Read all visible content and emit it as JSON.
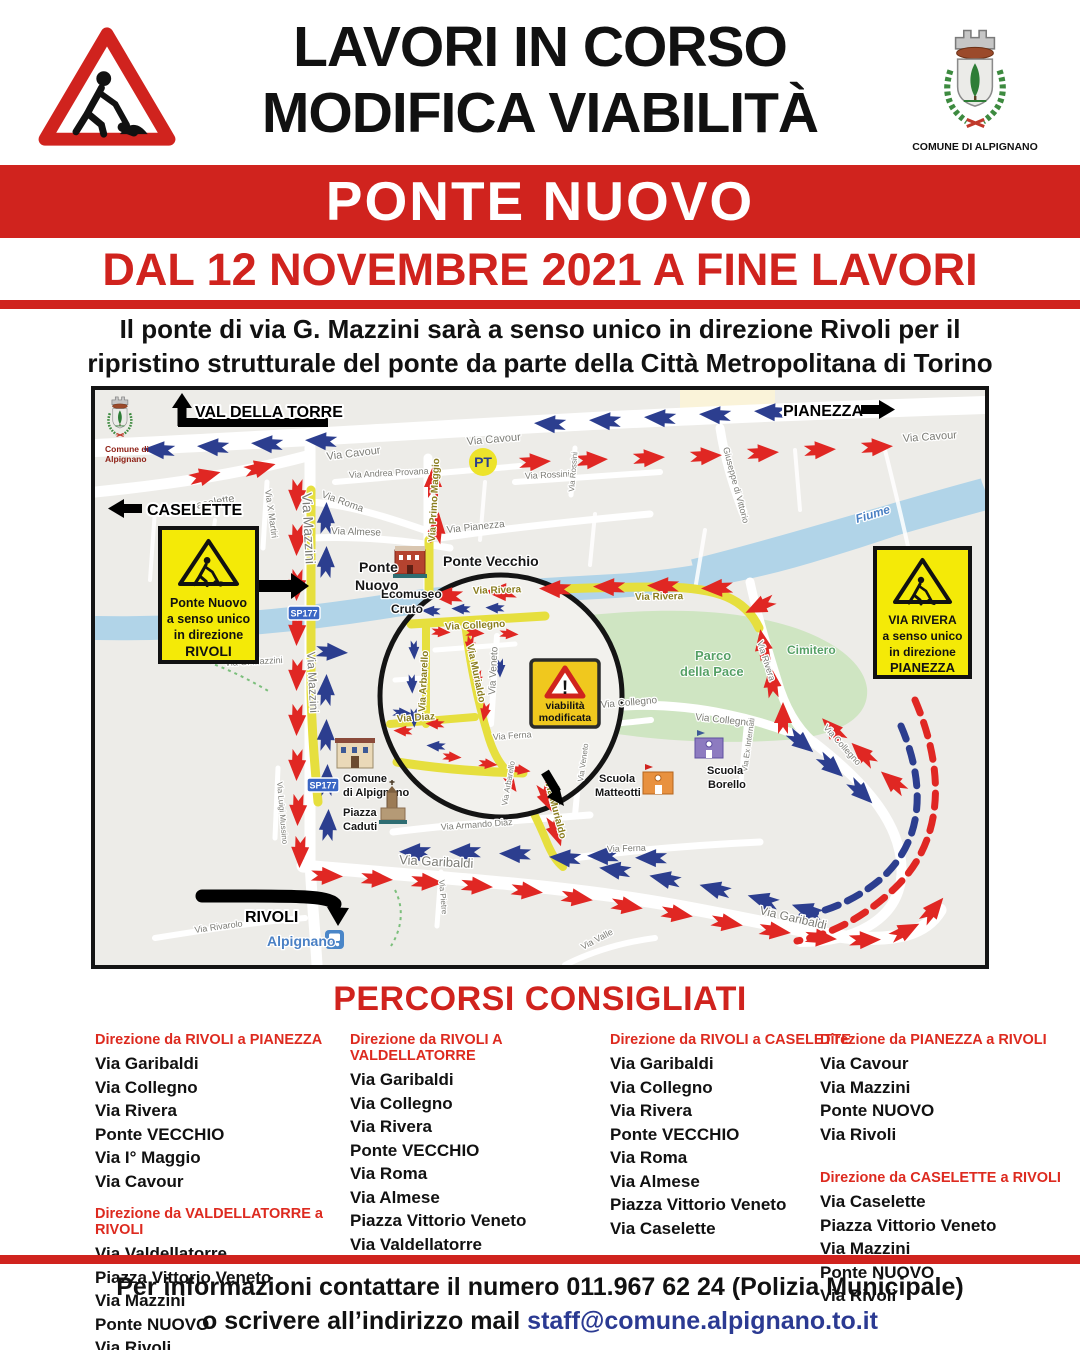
{
  "colors": {
    "poster_red": "#d0231e",
    "sign_yellow": "#f4ea07",
    "small_sign_yellow": "#f0c81e",
    "arrow_red": "#e02723",
    "arrow_blue": "#2c3e8f",
    "map_route_yellow": "#e6df3e",
    "river_blue": "#b1d4e8",
    "park_green": "#cfe5c2",
    "email_blue": "#2b3a92"
  },
  "header": {
    "title_line1": "LAVORI IN CORSO",
    "title_line2": "MODIFICA VIABILITÀ",
    "crest_caption": "COMUNE DI ALPIGNANO",
    "banner": "PONTE NUOVO",
    "date_line": "DAL 12 NOVEMBRE 2021 A FINE LAVORI",
    "subtitle_line1": "Il ponte di via G. Mazzini sarà a senso unico in direzione Rivoli per il",
    "subtitle_line2": "ripristino strutturale del ponte da parte della Città Metropolitana di Torino"
  },
  "map": {
    "direction_signs": {
      "val_della_torre": "VAL DELLA TORRE",
      "pianezza": "PIANEZZA",
      "caselette": "CASELETTE",
      "rivoli": "RIVOLI"
    },
    "warning_left": {
      "l1": "Ponte Nuovo",
      "l2": "a senso unico",
      "l3": "in direzione",
      "l4": "RIVOLI"
    },
    "warning_right": {
      "l1": "VIA RIVERA",
      "l2": "a senso unico",
      "l3": "in direzione",
      "l4": "PIANEZZA"
    },
    "warning_small": {
      "l1": "viabilità",
      "l2": "modificata"
    },
    "mini_crest": {
      "line1": "Comune di",
      "line2": "Alpignano"
    },
    "badges": {
      "sp177": "SP177",
      "pt": "PT"
    },
    "labels": {
      "cavour": "Via Cavour",
      "caselette": "Via Caselette",
      "x_martiri": "Via X Martiri",
      "mazzini": "Via Mazzini",
      "roma": "Via Roma",
      "almese": "Via Almese",
      "provana": "Via Andrea Provana",
      "primo_maggio": "Via Primo Maggio",
      "pianezza": "Via Pianezza",
      "rossini": "Via Rossini",
      "di_vittorio": "Giuseppe di Vittorio",
      "fiume": "Fiume",
      "rivera": "Via Rivera",
      "cimitero": "Cimitero",
      "parco_1": "Parco",
      "parco_2": "della Pace",
      "collegno": "Via Collegno",
      "ferna": "Via Ferna",
      "armando_diaz": "Via Armando Diaz",
      "garibaldi": "Via Garibaldi",
      "pietre": "Via Pietre",
      "mussino": "Via Luigi Mussino",
      "g_mazzini": "Via G. Mazzini",
      "rivarolo": "Via Rivarolo",
      "valle": "Via Valle",
      "murialdo": "Via Murialdo",
      "arbarello": "Via Arbarello",
      "veneto": "Via Veneto",
      "diaz": "Via Diaz",
      "ex_internati": "Via Ex Internati",
      "alpignano_town": "Alpignano"
    },
    "pois": {
      "ponte_nuovo_1": "Ponte",
      "ponte_nuovo_2": "Nuovo",
      "ponte_vecchio": "Ponte Vecchio",
      "ecomuseo_1": "Ecomuseo",
      "ecomuseo_2": "Cruto",
      "comune_1": "Comune",
      "comune_2": "di Alpignano",
      "piazza_1": "Piazza",
      "piazza_2": "Caduti",
      "scuola_m_1": "Scuola",
      "scuola_m_2": "Matteotti",
      "scuola_b_1": "Scuola",
      "scuola_b_2": "Borello"
    }
  },
  "routes": {
    "title": "PERCORSI CONSIGLIATI",
    "sections": [
      {
        "col": 0,
        "header": "Direzione da RIVOLI a PIANEZZA",
        "items": [
          "Via Garibaldi",
          "Via Collegno",
          "Via Rivera",
          "Ponte VECCHIO",
          "Via I° Maggio",
          "Via Cavour"
        ]
      },
      {
        "col": 0,
        "header": "Direzione da VALDELLATORRE a RIVOLI",
        "items": [
          "Via Valdellatorre",
          "Piazza Vittorio Veneto",
          "Via Mazzini",
          "Ponte NUOVO",
          "Via Rivoli"
        ]
      },
      {
        "col": 1,
        "header": "Direzione da RIVOLI A VALDELLATORRE",
        "items": [
          "Via Garibaldi",
          "Via Collegno",
          "Via Rivera",
          "Ponte VECCHIO",
          "Via Roma",
          "Via Almese",
          "Piazza Vittorio Veneto",
          "Via Valdellatorre"
        ]
      },
      {
        "col": 2,
        "header": "Direzione da RIVOLI a CASELETTE",
        "items": [
          "Via Garibaldi",
          "Via Collegno",
          "Via Rivera",
          "Ponte VECCHIO",
          "Via Roma",
          "Via Almese",
          "Piazza Vittorio Veneto",
          "Via Caselette"
        ]
      },
      {
        "col": 3,
        "header": "Direzione da PIANEZZA a RIVOLI",
        "items": [
          "Via Cavour",
          "Via Mazzini",
          "Ponte NUOVO",
          "Via Rivoli"
        ]
      },
      {
        "col": 3,
        "header": "Direzione da CASELETTE a RIVOLI",
        "items": [
          "Via Caselette",
          "Piazza Vittorio Veneto",
          "Via Mazzini",
          "Ponte NUOVO",
          "Via Rivoli"
        ]
      }
    ]
  },
  "footer": {
    "line1": "Per informazioni contattare il numero 011.967 62 24 (Polizia Municipale)",
    "line2_prefix": "o scrivere all’indirizzo mail ",
    "email": "staff@comune.alpignano.to.it"
  }
}
